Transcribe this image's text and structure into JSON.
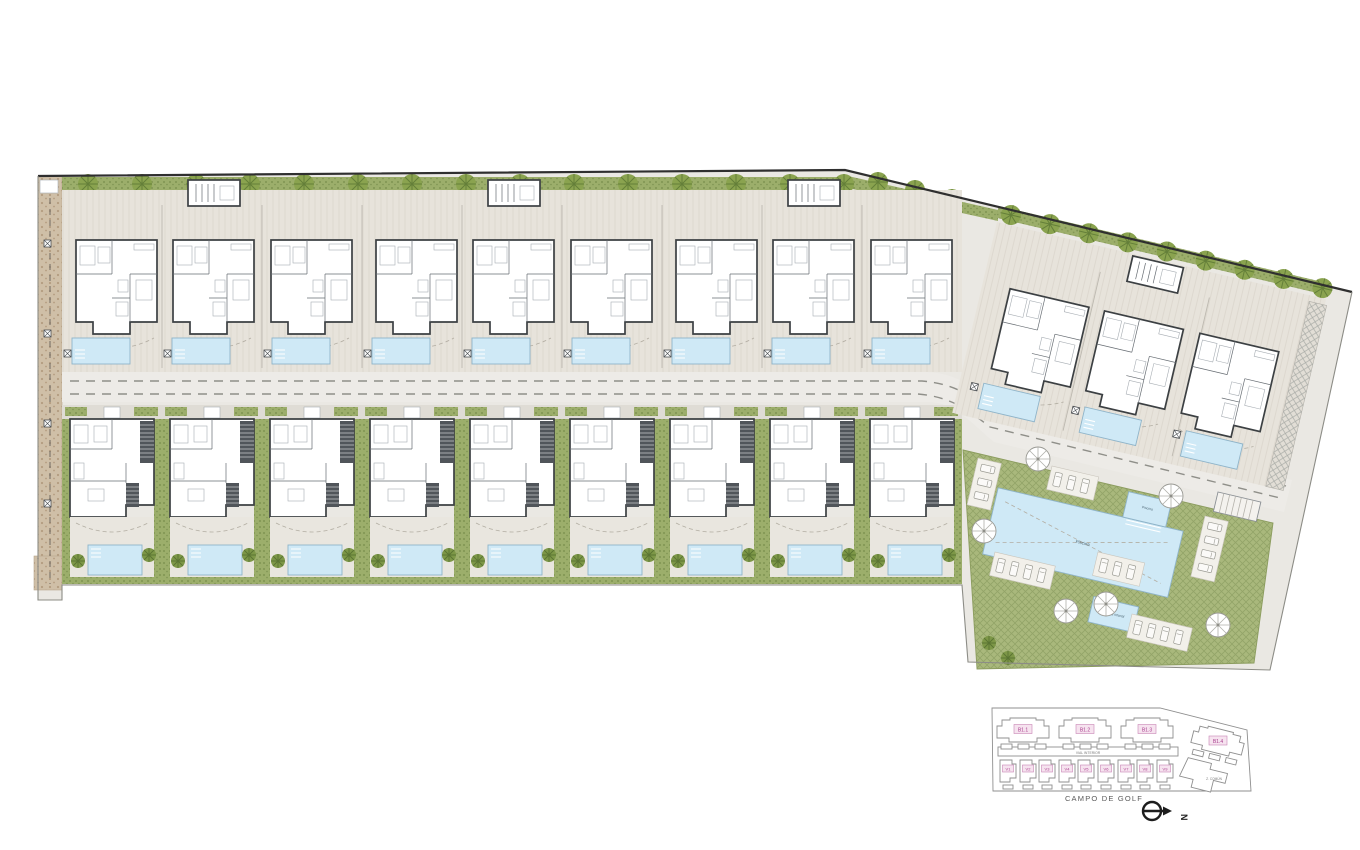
{
  "plan": {
    "golf_label": "CAMPO DE GOLF",
    "north_label": "N",
    "main_pool_label": "Piscina",
    "small_pool_label": "Piscina",
    "kids_pool_label": "Piscina infantil"
  },
  "keyplan": {
    "blocks": [
      "B1.1",
      "B1.2",
      "B1.3",
      "B1.4"
    ],
    "villas": [
      "V1",
      "V2",
      "V3",
      "V4",
      "V5",
      "V6",
      "V7",
      "V8",
      "V9"
    ],
    "road_label": "VIAL INTERIOR",
    "communal_label": "Z. COMÚN"
  },
  "icons": {
    "north_arrow": "circle-with-east-arrow",
    "tree": "round-canopy",
    "palm": "small-palm-canopy",
    "parasol": "umbrella-spokes"
  },
  "colors": {
    "paving": "#eae8e3",
    "deck": "#e7e3db",
    "deckline": "#ddd8cf",
    "road": "#edebe7",
    "pool": "#cfe9f6",
    "pooledge": "#8fb4c9",
    "lawn": "#a9b87c",
    "lawnx": "#93a468",
    "hedge": "#9cae6b",
    "hedgedot": "#7e9352",
    "tree": "#8aa34f",
    "treeline": "#647f39",
    "tan": "#cfbfa7",
    "tandot": "#b49c80",
    "wall": "#3c4043",
    "pink": "#a83d8e"
  }
}
